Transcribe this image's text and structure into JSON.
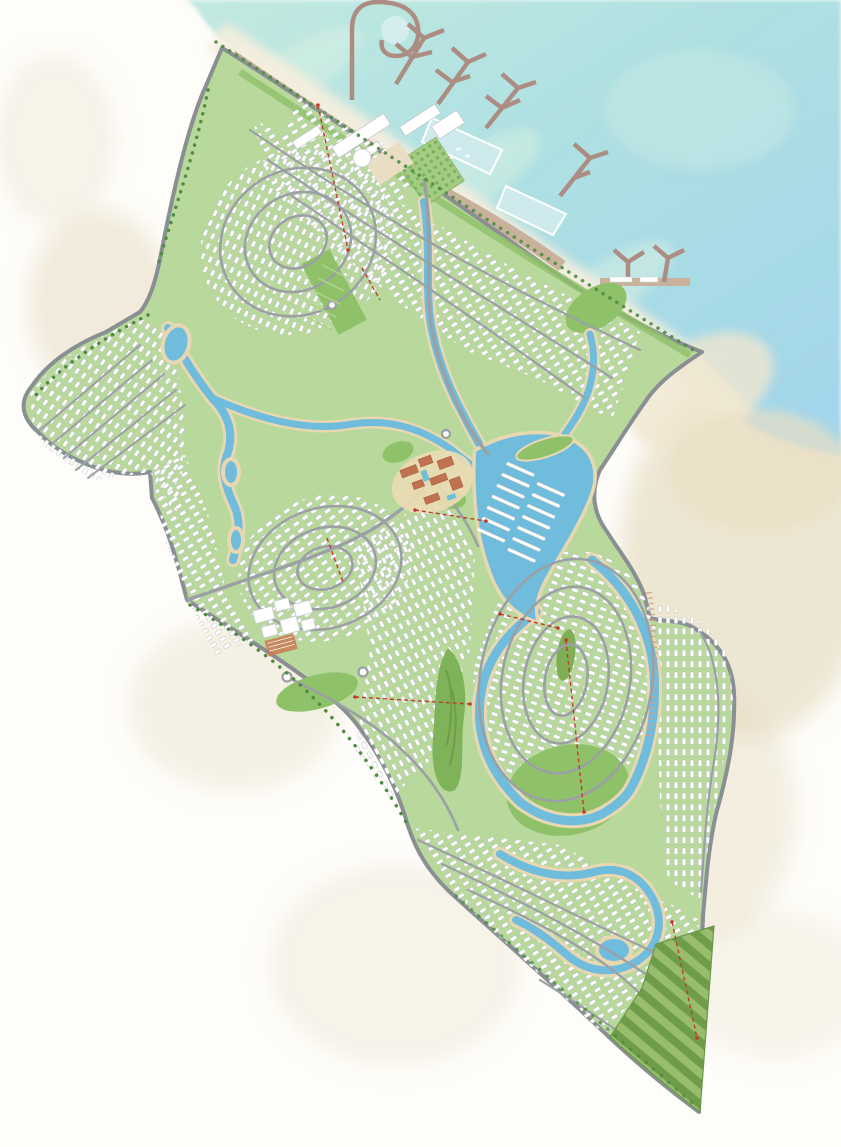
{
  "document": {
    "title": "Coastal resort master plan — illustrated site map",
    "note": "watercolor-style masterplan, sea at top right, development runs diagonally to a southern tip"
  },
  "palette": {
    "paper": "#fefdfa",
    "sand_wash": "#e9e0c8",
    "beach": "#f4eedd",
    "sea_top": "#c2e9e0",
    "sea_mid": "#aee0e2",
    "sea_deep": "#a3d6ea",
    "sea_shallow": "#d9f1e4",
    "land_green": "#b9d89c",
    "park_green": "#8fc169",
    "golf_green": "#7fb35a",
    "terrace_dark": "#6f9c49",
    "terrace_light": "#98bd6c",
    "orchard_green": "#79b258",
    "road_gray": "#9aa0a3",
    "perimeter_gray": "#898f92",
    "villa_white": "#ffffff",
    "villa_outline": "#b6bdc2",
    "lagoon_blue": "#6fbcdd",
    "lagoon_sand": "#e7d8b2",
    "pool_pale": "#cfeaec",
    "boardwalk_tan": "#c9b29c",
    "pier_mauve": "#ab8d84",
    "terracotta": "#c0714f",
    "campus_court": "#c77b52",
    "section_red": "#c23a2b",
    "tree_green": "#4f8c42"
  },
  "features": {
    "sea": "sea",
    "breakwater": "curled breakwater with harbor basin",
    "marina_piers": "branching marina piers",
    "pier_count": 6,
    "beach": "beach strip",
    "boardwalk": "waterfront promenade",
    "swim_lagoons": "beachfront swim lagoons",
    "swim_lagoon_count": 2,
    "marina_village": "marina village buildings",
    "orchard": "palm orchard grid",
    "villa_clusters": "curved rows of white villas",
    "lagoon_network": "inland winding lagoon network",
    "central_marina_docks": "central lagoon boat docks",
    "dock_count": 14,
    "town_center": "terracotta town centre with pools",
    "campus": "community campus with court",
    "central_park": "central park",
    "golf_island": "green island in west channel",
    "farm_terraces": "terraced fields at southern tip",
    "section_markers": "red dashed section markers",
    "section_marker_count": 8,
    "roundabout_count": 4
  }
}
